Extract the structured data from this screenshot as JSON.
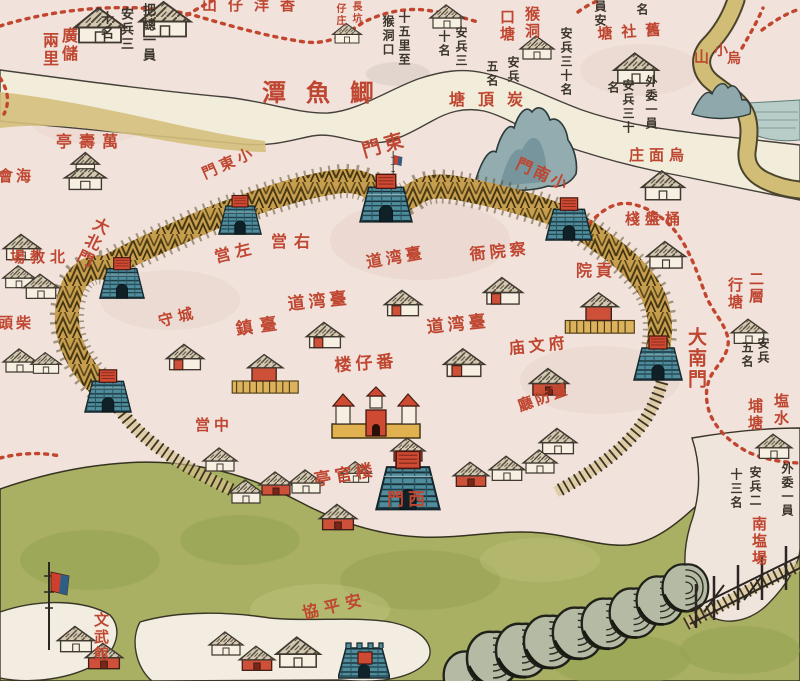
{
  "map": {
    "description_labels_note": "historical map of Taiwan prefecture city, bamboo palisade wall with gates",
    "palette": {
      "paper": "#f1e2dc",
      "water_band": "#f2ecda",
      "river_tan": "#d5c07c",
      "green_land": "#a9b063",
      "gate_teal": "#4f8d9d",
      "wall_gold": "#c69e4e",
      "red_label": "#bf4630",
      "ink": "#3b352c",
      "mountain": "#93acb0",
      "sea_patch": "#b9cdc8",
      "roof": "#d3c9b2",
      "red_building": "#cf5038"
    },
    "labels": [
      {
        "t": "山仔洋香",
        "x": 202,
        "y": -2,
        "c": "r",
        "s": 15,
        "ls": 11
      },
      {
        "t": "廣儲",
        "x": 60,
        "y": 27,
        "c": "r",
        "s": 16,
        "o": "v"
      },
      {
        "t": "兩里",
        "x": 41,
        "y": 32,
        "c": "r",
        "s": 16,
        "o": "v"
      },
      {
        "t": "把總一員",
        "x": 141,
        "y": 3,
        "c": "k",
        "s": 13,
        "o": "v"
      },
      {
        "t": "安兵三",
        "x": 119,
        "y": 7,
        "c": "k",
        "s": 13,
        "o": "v"
      },
      {
        "t": "十名",
        "x": 99,
        "y": 11,
        "c": "k",
        "s": 13,
        "o": "v"
      },
      {
        "t": "長坑",
        "x": 350,
        "y": 1,
        "c": "r",
        "s": 10,
        "o": "v"
      },
      {
        "t": "仔庄",
        "x": 334,
        "y": 3,
        "c": "r",
        "s": 10,
        "o": "v"
      },
      {
        "t": "十五里至",
        "x": 398,
        "y": 11,
        "c": "k",
        "s": 12,
        "o": "v"
      },
      {
        "t": "猴洞口",
        "x": 382,
        "y": 15,
        "c": "k",
        "s": 12,
        "o": "v"
      },
      {
        "t": "安兵三",
        "x": 455,
        "y": 26,
        "c": "k",
        "s": 12,
        "o": "v"
      },
      {
        "t": "十名",
        "x": 438,
        "y": 30,
        "c": "k",
        "s": 12,
        "o": "v"
      },
      {
        "t": "猴洞",
        "x": 524,
        "y": 6,
        "c": "r",
        "s": 15,
        "o": "v"
      },
      {
        "t": "口塘",
        "x": 499,
        "y": 9,
        "c": "r",
        "s": 15,
        "o": "v"
      },
      {
        "t": "安兵三十名",
        "x": 560,
        "y": 27,
        "c": "k",
        "s": 12,
        "o": "v"
      },
      {
        "t": "安兵",
        "x": 507,
        "y": 56,
        "c": "k",
        "s": 12,
        "o": "v"
      },
      {
        "t": "五名",
        "x": 486,
        "y": 60,
        "c": "k",
        "s": 12,
        "o": "v"
      },
      {
        "t": "塘頂炭",
        "x": 449,
        "y": 92,
        "c": "r",
        "s": 16,
        "ls": 13
      },
      {
        "t": "員安",
        "x": 594,
        "y": 0,
        "c": "k",
        "s": 12,
        "o": "v"
      },
      {
        "t": "名",
        "x": 636,
        "y": 3,
        "c": "k",
        "s": 12,
        "o": "v"
      },
      {
        "t": "塘社舊",
        "x": 597,
        "y": 27,
        "c": "r",
        "s": 15,
        "ls": 9,
        "rot": -4
      },
      {
        "t": "外委一員",
        "x": 645,
        "y": 75,
        "c": "k",
        "s": 12,
        "o": "v"
      },
      {
        "t": "安兵三十",
        "x": 622,
        "y": 79,
        "c": "k",
        "s": 12,
        "o": "v"
      },
      {
        "t": "名",
        "x": 607,
        "y": 81,
        "c": "k",
        "s": 12,
        "o": "v"
      },
      {
        "t": "小",
        "x": 714,
        "y": 44,
        "c": "r",
        "s": 14
      },
      {
        "t": "烏",
        "x": 727,
        "y": 52,
        "c": "r",
        "s": 14
      },
      {
        "t": "山",
        "x": 694,
        "y": 50,
        "c": "r",
        "s": 15
      },
      {
        "t": "潭魚鯽",
        "x": 262,
        "y": 81,
        "c": "r",
        "s": 24,
        "ls": 20
      },
      {
        "t": "亭壽萬",
        "x": 56,
        "y": 134,
        "c": "r",
        "s": 16,
        "ls": 7
      },
      {
        "t": "會海",
        "x": -2,
        "y": 169,
        "c": "r",
        "s": 15,
        "ls": 3
      },
      {
        "t": "場教北",
        "x": 10,
        "y": 250,
        "c": "r",
        "s": 15,
        "ls": 5
      },
      {
        "t": "頭柴",
        "x": -2,
        "y": 316,
        "c": "r",
        "s": 15,
        "ls": 3
      },
      {
        "t": "大北門",
        "x": 96,
        "y": 214,
        "c": "r",
        "s": 16,
        "o": "v",
        "rot": 26
      },
      {
        "t": "門東小",
        "x": 200,
        "y": 168,
        "c": "r",
        "s": 15,
        "ls": 4,
        "rot": -24
      },
      {
        "t": "門東",
        "x": 360,
        "y": 143,
        "c": "r",
        "s": 19,
        "ls": 4,
        "rot": -16
      },
      {
        "t": "門南小",
        "x": 520,
        "y": 156,
        "c": "r",
        "s": 16,
        "ls": 3,
        "rot": 24
      },
      {
        "t": "庄面烏",
        "x": 629,
        "y": 148,
        "c": "r",
        "s": 15,
        "ls": 5
      },
      {
        "t": "棧盤桶",
        "x": 625,
        "y": 212,
        "c": "r",
        "s": 15,
        "ls": 5
      },
      {
        "t": "大南門",
        "x": 686,
        "y": 327,
        "c": "r",
        "s": 19,
        "o": "v"
      },
      {
        "t": "二層",
        "x": 748,
        "y": 271,
        "c": "r",
        "s": 15,
        "o": "v"
      },
      {
        "t": "行塘",
        "x": 727,
        "y": 277,
        "c": "r",
        "s": 15,
        "o": "v"
      },
      {
        "t": "安兵",
        "x": 757,
        "y": 337,
        "c": "k",
        "s": 12,
        "o": "v"
      },
      {
        "t": "五名",
        "x": 741,
        "y": 341,
        "c": "k",
        "s": 12,
        "o": "v"
      },
      {
        "t": "塩水",
        "x": 773,
        "y": 393,
        "c": "r",
        "s": 15,
        "o": "v"
      },
      {
        "t": "埔塘",
        "x": 747,
        "y": 398,
        "c": "r",
        "s": 15,
        "o": "v"
      },
      {
        "t": "外委一員",
        "x": 781,
        "y": 462,
        "c": "k",
        "s": 12,
        "o": "v"
      },
      {
        "t": "安兵二",
        "x": 749,
        "y": 466,
        "c": "k",
        "s": 12,
        "o": "v"
      },
      {
        "t": "十三名",
        "x": 730,
        "y": 468,
        "c": "k",
        "s": 12,
        "o": "v"
      },
      {
        "t": "南塩場",
        "x": 751,
        "y": 516,
        "c": "r",
        "s": 15,
        "o": "v"
      },
      {
        "t": "営右",
        "x": 271,
        "y": 234,
        "c": "r",
        "s": 16,
        "ls": 7
      },
      {
        "t": "営左",
        "x": 213,
        "y": 250,
        "c": "r",
        "s": 16,
        "ls": 5,
        "rot": -14
      },
      {
        "t": "道湾臺",
        "x": 365,
        "y": 255,
        "c": "r",
        "s": 16,
        "ls": 4,
        "rot": -10
      },
      {
        "t": "道湾臺",
        "x": 287,
        "y": 297,
        "c": "r",
        "s": 17,
        "ls": 4,
        "rot": -6
      },
      {
        "t": "道湾臺",
        "x": 426,
        "y": 320,
        "c": "r",
        "s": 17,
        "ls": 4,
        "rot": -6
      },
      {
        "t": "鎮臺",
        "x": 235,
        "y": 322,
        "c": "r",
        "s": 17,
        "ls": 7,
        "rot": -8
      },
      {
        "t": "守城",
        "x": 157,
        "y": 315,
        "c": "r",
        "s": 15,
        "ls": 5,
        "rot": -14
      },
      {
        "t": "衙院察",
        "x": 469,
        "y": 247,
        "c": "r",
        "s": 16,
        "ls": 4,
        "rot": -6
      },
      {
        "t": "院貢",
        "x": 576,
        "y": 263,
        "c": "r",
        "s": 16,
        "ls": 4
      },
      {
        "t": "庙文府",
        "x": 508,
        "y": 341,
        "c": "r",
        "s": 16,
        "ls": 4,
        "rot": -6
      },
      {
        "t": "廳防臺",
        "x": 516,
        "y": 400,
        "c": "r",
        "s": 15,
        "ls": 3,
        "rot": -20
      },
      {
        "t": "楼仔番",
        "x": 334,
        "y": 358,
        "c": "r",
        "s": 17,
        "ls": 4,
        "rot": -4
      },
      {
        "t": "営中",
        "x": 195,
        "y": 418,
        "c": "r",
        "s": 15,
        "ls": 4
      },
      {
        "t": "亭官楼",
        "x": 313,
        "y": 473,
        "c": "r",
        "s": 17,
        "ls": 4,
        "rot": -10
      },
      {
        "t": "門西",
        "x": 387,
        "y": 492,
        "c": "r",
        "s": 17,
        "ls": 4
      },
      {
        "t": "協平安",
        "x": 301,
        "y": 606,
        "c": "r",
        "s": 16,
        "ls": 6,
        "rot": -13
      },
      {
        "t": "文武館",
        "x": 93,
        "y": 612,
        "c": "r",
        "s": 15,
        "o": "v"
      }
    ],
    "markers": [
      {
        "t": "h",
        "x": 70,
        "y": 2,
        "s": 1.5
      },
      {
        "t": "h",
        "x": 135,
        "y": -4,
        "s": 1.5
      },
      {
        "t": "h",
        "x": 330,
        "y": 20,
        "s": 0.85
      },
      {
        "t": "h",
        "x": 427,
        "y": 1,
        "s": 1.0
      },
      {
        "t": "h",
        "x": 517,
        "y": 32,
        "s": 1.0
      },
      {
        "t": "h",
        "x": 610,
        "y": 48,
        "s": 1.3
      },
      {
        "t": "h",
        "x": 638,
        "y": 166,
        "s": 1.25
      },
      {
        "t": "h",
        "x": 643,
        "y": 237,
        "s": 1.15
      },
      {
        "t": "temple",
        "x": 60,
        "y": 148,
        "s": 1.15
      },
      {
        "t": "h",
        "x": 0,
        "y": 230,
        "s": 1.1
      },
      {
        "t": "h",
        "x": 0,
        "y": 262,
        "s": 0.95
      },
      {
        "t": "h",
        "x": 20,
        "y": 270,
        "s": 1.05
      },
      {
        "t": "h",
        "x": 0,
        "y": 345,
        "s": 1.0
      },
      {
        "t": "h",
        "x": 28,
        "y": 349,
        "s": 0.9
      },
      {
        "t": "hd",
        "x": 163,
        "y": 340,
        "s": 1.1
      },
      {
        "t": "hd",
        "x": 381,
        "y": 286,
        "s": 1.1
      },
      {
        "t": "hd",
        "x": 303,
        "y": 318,
        "s": 1.1
      },
      {
        "t": "hd",
        "x": 440,
        "y": 344,
        "s": 1.2
      },
      {
        "t": "cmpd",
        "x": 230,
        "y": 348,
        "s": 1.1
      },
      {
        "t": "hd",
        "x": 480,
        "y": 273,
        "s": 1.15
      },
      {
        "t": "cmpd",
        "x": 563,
        "y": 286,
        "s": 1.15
      },
      {
        "t": "hr",
        "x": 526,
        "y": 364,
        "s": 1.15
      },
      {
        "t": "h",
        "x": 536,
        "y": 424,
        "s": 1.1
      },
      {
        "t": "h",
        "x": 200,
        "y": 444,
        "s": 1.0
      },
      {
        "t": "tower",
        "x": 330,
        "y": 384,
        "s": 1
      },
      {
        "t": "h",
        "x": 226,
        "y": 476,
        "s": 1.0
      },
      {
        "t": "hr",
        "x": 256,
        "y": 468,
        "s": 1.0
      },
      {
        "t": "h",
        "x": 286,
        "y": 466,
        "s": 1.0
      },
      {
        "t": "hr",
        "x": 316,
        "y": 500,
        "s": 1.1
      },
      {
        "t": "h",
        "x": 338,
        "y": 458,
        "s": 0.9
      },
      {
        "t": "hr",
        "x": 450,
        "y": 458,
        "s": 1.05
      },
      {
        "t": "h",
        "x": 486,
        "y": 452,
        "s": 1.05
      },
      {
        "t": "h",
        "x": 520,
        "y": 446,
        "s": 1.0
      },
      {
        "t": "hr",
        "x": 388,
        "y": 434,
        "s": 1.0
      },
      {
        "t": "h",
        "x": 728,
        "y": 315,
        "s": 1.05
      },
      {
        "t": "h",
        "x": 753,
        "y": 430,
        "s": 1.05
      },
      {
        "t": "h",
        "x": 54,
        "y": 622,
        "s": 1.1
      },
      {
        "t": "hr",
        "x": 82,
        "y": 639,
        "s": 1.1
      },
      {
        "t": "h",
        "x": 206,
        "y": 628,
        "s": 1.0
      },
      {
        "t": "hr",
        "x": 236,
        "y": 642,
        "s": 1.05
      },
      {
        "t": "h",
        "x": 272,
        "y": 632,
        "s": 1.3
      },
      {
        "t": "fort",
        "x": 338,
        "y": 634,
        "s": 1
      },
      {
        "t": "flag",
        "x": 42,
        "y": 560,
        "s": 1
      },
      {
        "t": "flag",
        "x": 390,
        "y": 150,
        "s": 0.45
      },
      {
        "t": "tree",
        "x": 440,
        "y": 648,
        "s": 0.92
      },
      {
        "t": "tree",
        "x": 463,
        "y": 628,
        "s": 1.0
      },
      {
        "t": "tree",
        "x": 492,
        "y": 620,
        "s": 1.0
      },
      {
        "t": "tree",
        "x": 520,
        "y": 612,
        "s": 0.98
      },
      {
        "t": "tree",
        "x": 549,
        "y": 604,
        "s": 0.96
      },
      {
        "t": "tree",
        "x": 578,
        "y": 595,
        "s": 0.94
      },
      {
        "t": "tree",
        "x": 606,
        "y": 585,
        "s": 0.92
      },
      {
        "t": "tree",
        "x": 633,
        "y": 573,
        "s": 0.9
      },
      {
        "t": "tree",
        "x": 659,
        "y": 561,
        "s": 0.88
      }
    ],
    "gates": [
      {
        "id": "dabei-men",
        "x": 98,
        "y": 254,
        "w": 48,
        "h": 46
      },
      {
        "id": "xiaodong-men",
        "x": 216,
        "y": 192,
        "w": 48,
        "h": 44
      },
      {
        "id": "dong-men",
        "x": 356,
        "y": 170,
        "w": 60,
        "h": 54
      },
      {
        "id": "xiaonan-men",
        "x": 543,
        "y": 194,
        "w": 52,
        "h": 48
      },
      {
        "id": "danan-men",
        "x": 632,
        "y": 332,
        "w": 52,
        "h": 50
      },
      {
        "id": "xiaobei-men",
        "x": 80,
        "y": 366,
        "w": 56,
        "h": 48
      },
      {
        "id": "xi-men",
        "x": 364,
        "y": 446,
        "w": 88,
        "h": 66
      }
    ]
  }
}
